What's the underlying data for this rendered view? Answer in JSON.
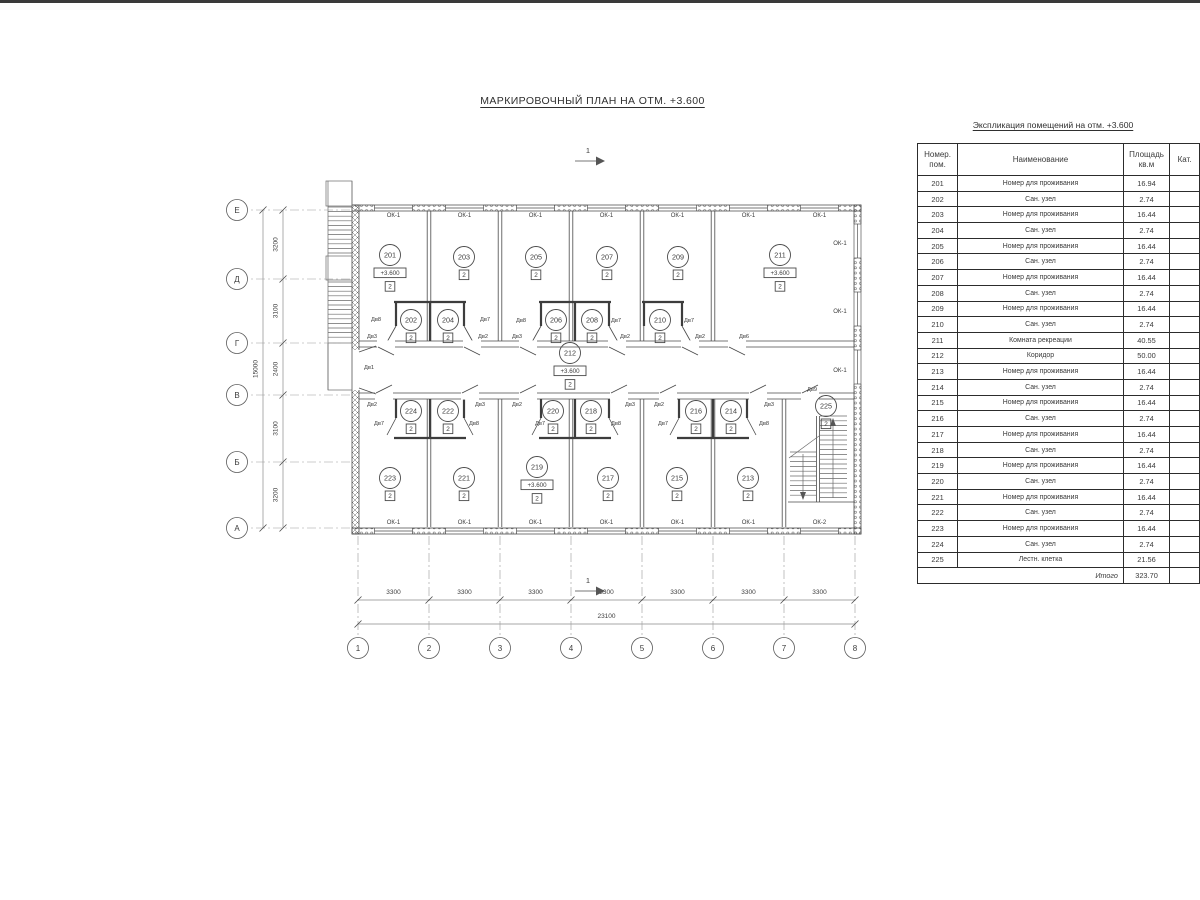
{
  "page": {
    "plan_title": "МАРКИРОВОЧНЫЙ ПЛАН НА ОТМ. +3.600"
  },
  "explication": {
    "title": "Экспликация помещений на отм. +3.600",
    "columns": {
      "num": [
        "Номер.",
        "пом."
      ],
      "name": [
        "Наименование"
      ],
      "area": [
        "Площадь",
        "кв.м"
      ],
      "cat": [
        "Кат."
      ]
    },
    "rows": [
      [
        "201",
        "Номер для проживания",
        "16.94"
      ],
      [
        "202",
        "Сан. узел",
        "2.74"
      ],
      [
        "203",
        "Номер для проживания",
        "16.44"
      ],
      [
        "204",
        "Сан. узел",
        "2.74"
      ],
      [
        "205",
        "Номер для проживания",
        "16.44"
      ],
      [
        "206",
        "Сан. узел",
        "2.74"
      ],
      [
        "207",
        "Номер для проживания",
        "16.44"
      ],
      [
        "208",
        "Сан. узел",
        "2.74"
      ],
      [
        "209",
        "Номер для проживания",
        "16.44"
      ],
      [
        "210",
        "Сан. узел",
        "2.74"
      ],
      [
        "211",
        "Комната рекреации",
        "40.55"
      ],
      [
        "212",
        "Коридор",
        "50.00"
      ],
      [
        "213",
        "Номер для проживания",
        "16.44"
      ],
      [
        "214",
        "Сан. узел",
        "2.74"
      ],
      [
        "215",
        "Номер для проживания",
        "16.44"
      ],
      [
        "216",
        "Сан. узел",
        "2.74"
      ],
      [
        "217",
        "Номер для проживания",
        "16.44"
      ],
      [
        "218",
        "Сан. узел",
        "2.74"
      ],
      [
        "219",
        "Номер для проживания",
        "16.44"
      ],
      [
        "220",
        "Сан. узел",
        "2.74"
      ],
      [
        "221",
        "Номер для проживания",
        "16.44"
      ],
      [
        "222",
        "Сан. узел",
        "2.74"
      ],
      [
        "223",
        "Номер для проживания",
        "16.44"
      ],
      [
        "224",
        "Сан. узел",
        "2.74"
      ],
      [
        "225",
        "Лестн. клетка",
        "21.56"
      ]
    ],
    "total_label": "Итого",
    "total_value": "323.70"
  },
  "plan": {
    "elevation_value": "+3.600",
    "category_value": "2",
    "rooms": [
      {
        "num": "201",
        "x": 390,
        "y": 255,
        "elev": true
      },
      {
        "num": "202",
        "x": 411,
        "y": 320
      },
      {
        "num": "203",
        "x": 464,
        "y": 257
      },
      {
        "num": "204",
        "x": 448,
        "y": 320
      },
      {
        "num": "205",
        "x": 536,
        "y": 257
      },
      {
        "num": "206",
        "x": 556,
        "y": 320
      },
      {
        "num": "207",
        "x": 607,
        "y": 257
      },
      {
        "num": "208",
        "x": 592,
        "y": 320
      },
      {
        "num": "209",
        "x": 678,
        "y": 257
      },
      {
        "num": "210",
        "x": 660,
        "y": 320
      },
      {
        "num": "211",
        "x": 780,
        "y": 255,
        "elev": true
      },
      {
        "num": "212",
        "x": 570,
        "y": 353,
        "elev": true
      },
      {
        "num": "213",
        "x": 748,
        "y": 478
      },
      {
        "num": "214",
        "x": 731,
        "y": 411
      },
      {
        "num": "215",
        "x": 677,
        "y": 478
      },
      {
        "num": "216",
        "x": 696,
        "y": 411
      },
      {
        "num": "217",
        "x": 608,
        "y": 478
      },
      {
        "num": "218",
        "x": 591,
        "y": 411
      },
      {
        "num": "219",
        "x": 537,
        "y": 467,
        "elev": true
      },
      {
        "num": "220",
        "x": 553,
        "y": 411
      },
      {
        "num": "221",
        "x": 464,
        "y": 478
      },
      {
        "num": "222",
        "x": 448,
        "y": 411
      },
      {
        "num": "223",
        "x": 390,
        "y": 478
      },
      {
        "num": "224",
        "x": 411,
        "y": 411
      },
      {
        "num": "225",
        "x": 826,
        "y": 406
      }
    ],
    "door_labels": [
      {
        "t": "Дв8",
        "x": 376,
        "y": 321
      },
      {
        "t": "Дв7",
        "x": 485,
        "y": 321
      },
      {
        "t": "Дв8",
        "x": 521,
        "y": 322
      },
      {
        "t": "Дв7",
        "x": 616,
        "y": 322
      },
      {
        "t": "Дв7",
        "x": 689,
        "y": 322
      },
      {
        "t": "Дв3",
        "x": 372,
        "y": 338
      },
      {
        "t": "Дв2",
        "x": 483,
        "y": 338
      },
      {
        "t": "Дв3",
        "x": 517,
        "y": 338
      },
      {
        "t": "Дв2",
        "x": 625,
        "y": 338
      },
      {
        "t": "Дв2",
        "x": 700,
        "y": 338
      },
      {
        "t": "Дв6",
        "x": 744,
        "y": 338
      },
      {
        "t": "Дв1",
        "x": 369,
        "y": 369
      },
      {
        "t": "Дв2",
        "x": 372,
        "y": 406
      },
      {
        "t": "Дв3",
        "x": 480,
        "y": 406
      },
      {
        "t": "Дв2",
        "x": 517,
        "y": 406
      },
      {
        "t": "Дв3",
        "x": 630,
        "y": 406
      },
      {
        "t": "Дв2",
        "x": 659,
        "y": 406
      },
      {
        "t": "Дв3",
        "x": 769,
        "y": 406
      },
      {
        "t": "Дв9",
        "x": 812,
        "y": 391
      },
      {
        "t": "Дв7",
        "x": 379,
        "y": 425
      },
      {
        "t": "Дв8",
        "x": 474,
        "y": 425
      },
      {
        "t": "Дв7",
        "x": 540,
        "y": 425
      },
      {
        "t": "Дв8",
        "x": 616,
        "y": 425
      },
      {
        "t": "Дв7",
        "x": 663,
        "y": 425
      },
      {
        "t": "Дв8",
        "x": 764,
        "y": 425
      }
    ],
    "window_labels": [
      {
        "t": "ОК-1",
        "x": 393.5,
        "y": 217
      },
      {
        "t": "ОК-1",
        "x": 464.5,
        "y": 217
      },
      {
        "t": "ОК-1",
        "x": 535.5,
        "y": 217
      },
      {
        "t": "ОК-1",
        "x": 606.5,
        "y": 217
      },
      {
        "t": "ОК-1",
        "x": 677.5,
        "y": 217
      },
      {
        "t": "ОК-1",
        "x": 748.5,
        "y": 217
      },
      {
        "t": "ОК-1",
        "x": 819.5,
        "y": 217
      },
      {
        "t": "ОК-1",
        "x": 393.5,
        "y": 524
      },
      {
        "t": "ОК-1",
        "x": 464.5,
        "y": 524
      },
      {
        "t": "ОК-1",
        "x": 535.5,
        "y": 524
      },
      {
        "t": "ОК-1",
        "x": 606.5,
        "y": 524
      },
      {
        "t": "ОК-1",
        "x": 677.5,
        "y": 524
      },
      {
        "t": "ОК-1",
        "x": 748.5,
        "y": 524
      },
      {
        "t": "ОК-2",
        "x": 819.5,
        "y": 524
      },
      {
        "t": "ОК-1",
        "x": 840,
        "y": 245
      },
      {
        "t": "ОК-1",
        "x": 840,
        "y": 313
      },
      {
        "t": "ОК-1",
        "x": 840,
        "y": 372
      }
    ],
    "windows": {
      "top": [
        393.5,
        464.5,
        535.5,
        606.5,
        677.5,
        748.5,
        819.5
      ],
      "bottom": [
        393.5,
        464.5,
        535.5,
        606.5,
        677.5,
        748.5,
        819.5
      ],
      "right": [
        241,
        309,
        367
      ]
    },
    "san_blocks": [
      {
        "x": 396,
        "w": 68,
        "band": "u",
        "div": true,
        "leaves": "lr"
      },
      {
        "x": 541,
        "w": 68,
        "band": "u",
        "div": true,
        "leaves": "lr"
      },
      {
        "x": 644,
        "w": 38,
        "band": "u",
        "div": false,
        "leaves": "r"
      },
      {
        "x": 396,
        "w": 68,
        "band": "l",
        "div": true,
        "leaves": "lr"
      },
      {
        "x": 541,
        "w": 68,
        "band": "l",
        "div": true,
        "leaves": "lr"
      },
      {
        "x": 679,
        "w": 68,
        "band": "l",
        "div": true,
        "leaves": "lr"
      }
    ],
    "corridor_doors": {
      "top": [
        386,
        472,
        528,
        617,
        690,
        737
      ],
      "bottom": [
        384,
        470,
        528,
        619,
        668,
        758,
        810
      ]
    },
    "axes": {
      "cols": [
        {
          "label": "1",
          "x": 358
        },
        {
          "label": "2",
          "x": 429
        },
        {
          "label": "3",
          "x": 500
        },
        {
          "label": "4",
          "x": 571
        },
        {
          "label": "5",
          "x": 642
        },
        {
          "label": "6",
          "x": 713
        },
        {
          "label": "7",
          "x": 784
        },
        {
          "label": "8",
          "x": 855
        }
      ],
      "rows": [
        {
          "label": "Е",
          "y": 210
        },
        {
          "label": "Д",
          "y": 279
        },
        {
          "label": "Г",
          "y": 343
        },
        {
          "label": "В",
          "y": 395
        },
        {
          "label": "Б",
          "y": 462
        },
        {
          "label": "А",
          "y": 528
        }
      ]
    },
    "dims": {
      "bottom_segments": [
        {
          "label": "3300",
          "x": 393.5
        },
        {
          "label": "3300",
          "x": 464.5
        },
        {
          "label": "3300",
          "x": 535.5
        },
        {
          "label": "3300",
          "x": 606.5
        },
        {
          "label": "3300",
          "x": 677.5
        },
        {
          "label": "3300",
          "x": 748.5
        },
        {
          "label": "3300",
          "x": 819.5
        }
      ],
      "bottom_total": {
        "label": "23100",
        "x": 606.5
      },
      "left_segments": [
        {
          "label": "3200",
          "y": 244.5
        },
        {
          "label": "3100",
          "y": 311
        },
        {
          "label": "2400",
          "y": 369
        },
        {
          "label": "3100",
          "y": 428.5
        },
        {
          "label": "3200",
          "y": 495
        }
      ],
      "left_total": {
        "label": "15000",
        "y": 369
      }
    },
    "section_marks": [
      {
        "label": "1",
        "x": 588,
        "y": 153
      },
      {
        "label": "1",
        "x": 588,
        "y": 583
      }
    ]
  }
}
